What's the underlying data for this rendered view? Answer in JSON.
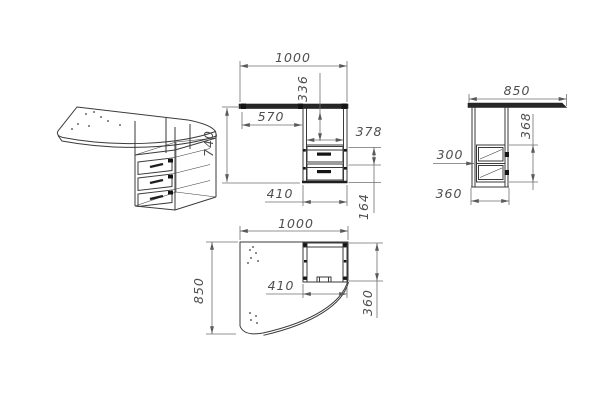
{
  "drawing": {
    "type": "furniture-technical-drawing",
    "subject": "corner computer desk with drawer pedestal",
    "views": [
      "isometric",
      "front",
      "side",
      "plan"
    ]
  },
  "views": {
    "front": {
      "dims": {
        "width": "1000",
        "niche_height": "336",
        "left_offset": "570",
        "inner_width": "378",
        "height": "740",
        "cabinet_width": "410",
        "drawer_pitch": "164"
      }
    },
    "side": {
      "dims": {
        "depth": "850",
        "unit_height": "368",
        "drawer_depth": "300",
        "cabinet_depth": "360"
      }
    },
    "plan": {
      "dims": {
        "width": "1000",
        "depth": "850",
        "cabinet_width": "410",
        "cabinet_depth": "360"
      }
    }
  },
  "colors": {
    "line": "#3a3a3a",
    "dim_line": "#6f6f6f",
    "text": "#4e4e4e",
    "dark_fill": "#141414",
    "background": "#ffffff"
  }
}
